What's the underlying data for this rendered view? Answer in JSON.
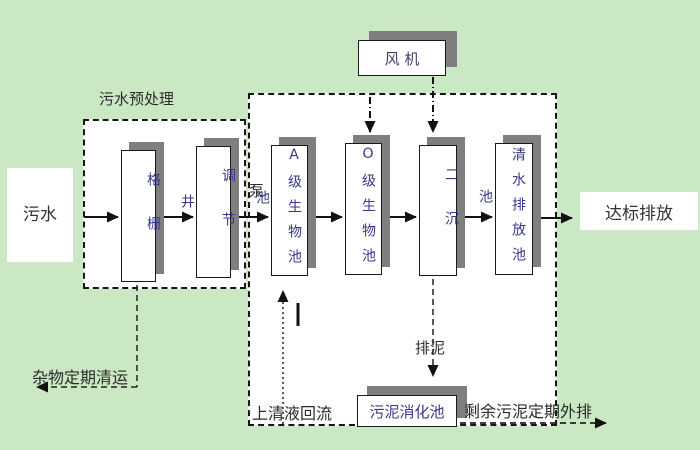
{
  "diagram": {
    "title": "sewage treatment process flow diagram",
    "colors": {
      "background": "#cae8c4",
      "panel": "#ffffff",
      "shadow": "#7f7f7f",
      "line": "#111111",
      "tank_text": "#38388c",
      "label_text": "#2b2b2b"
    }
  },
  "nodes": {
    "influent": {
      "label": "污水"
    },
    "fan": {
      "label": "风 机"
    },
    "grid_well": {
      "label": "格栅井"
    },
    "regulating_tank": {
      "label": "调节池"
    },
    "tank_a": {
      "label": "A级生物池"
    },
    "tank_o": {
      "label": "O级生物池"
    },
    "secondary_clarifier": {
      "label": "二沉池"
    },
    "clear_water_tank": {
      "label": "清水排放池"
    },
    "sludge_digester": {
      "label": "污泥消化池"
    },
    "effluent": {
      "label": "达标排放"
    }
  },
  "labels": {
    "pretreatment": "污水预处理",
    "pump": "泵",
    "debris_removal": "杂物定期清运",
    "supernatant_return": "上清液回流",
    "sludge_discharge": "排泥",
    "excess_sludge_out": "剩余污泥定期外排"
  }
}
